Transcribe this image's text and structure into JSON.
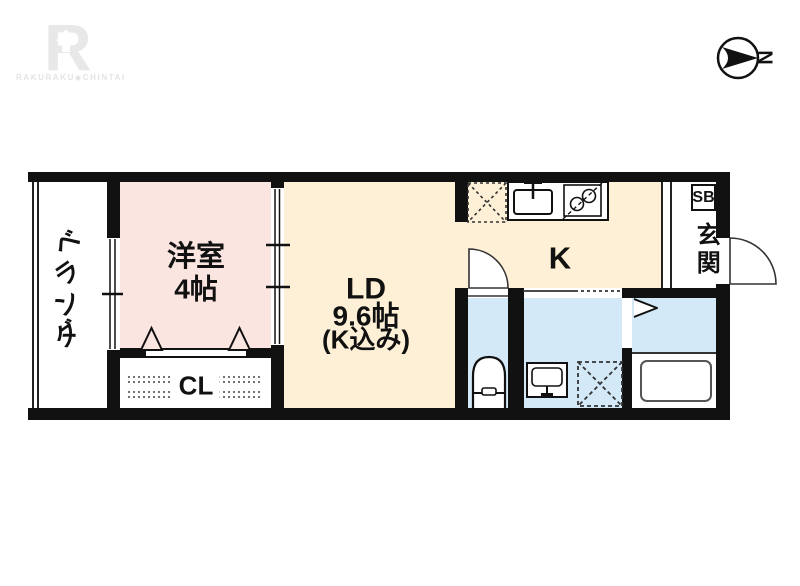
{
  "brand": {
    "logo_letter": "R",
    "logo_text": "RAKURAKU◆CHINTAI"
  },
  "compass": {
    "north_label": "N"
  },
  "floorplan": {
    "balcony_label": "ベランダ",
    "bedroom_name": "洋室",
    "bedroom_size": "4帖",
    "living_name": "LD",
    "living_size": "9.6帖",
    "living_note": "(K込み)",
    "kitchen_label": "K",
    "closet_label": "CL",
    "entrance_label": "玄関",
    "shoebox_label": "SB"
  },
  "colors": {
    "wall": "#111111",
    "bedroom_floor": "#FBE5E1",
    "living_floor": "#FDF0D6",
    "wet_area_floor": "#D4E9F7",
    "logo_gray": "#E8E8E8"
  }
}
